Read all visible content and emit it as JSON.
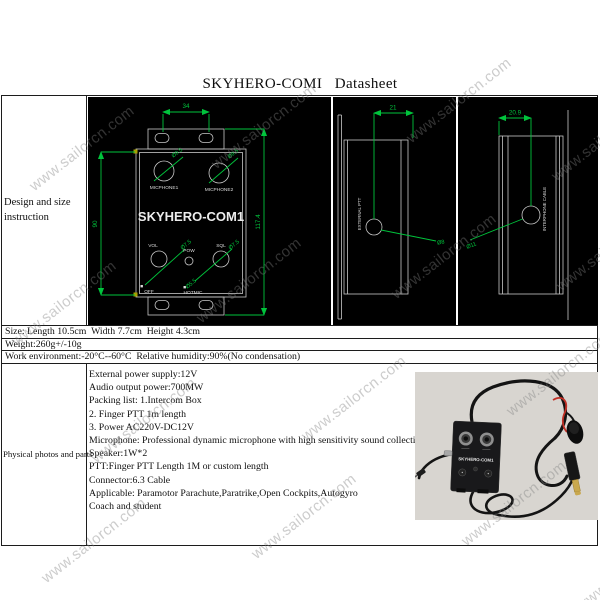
{
  "title": "SKYHERO-COMI   Datasheet",
  "watermark": "www.sailorcn.com",
  "rows": {
    "design_label": "Design and size instruction",
    "size": "Size: Length 10.5cm  Width 7.7cm  Height 4.3cm",
    "weight": "Weight:260g+/-10g",
    "environment": "Work environment:-20°C--60°C  Relative humidity:90%(No condensation)",
    "photos_label": "Physical photos and parts"
  },
  "specs": [
    "External power supply:12V",
    "Audio output power:700MW",
    "Packing list: 1.Intercom Box",
    "2. Finger PTT 1m length",
    "3. Power AC220V-DC12V",
    "Microphone: Professional dynamic microphone with high sensitivity sound collection",
    "Speaker:1W*2",
    "PTT:Finger PTT Length 1M or custom length",
    "Connector:6.3 Cable",
    "Applicable: Paramotor Parachute,Paratrike,Open Cockpits,Autogyro",
    "Coach and student"
  ],
  "drawings": {
    "front": {
      "dim_width_top": "34",
      "dim_height_left": "90",
      "dim_height_right": "117.4",
      "mic1": "MICPHONE1",
      "mic2": "MICPHONE2",
      "name": "SKYHERO-COM1",
      "vol": "VOL",
      "pow": "POW",
      "sql": "SQL",
      "off": "OFF",
      "hotmic": "HOTMIC",
      "mic_hole_dia": "Ø9.5",
      "knob_dia": "Ø7.5",
      "small_hole_dia": "Ø5.5"
    },
    "side_left": {
      "dim_top": "21",
      "label": "EXTERNAL PTT",
      "hole_dia": "Ø8"
    },
    "side_right": {
      "dim_top": "20.9",
      "label": "INTERPHONE CABLE",
      "hole_dia": "Ø11"
    }
  },
  "photo": {
    "device_label": "SKYHERO-COM1"
  },
  "colors": {
    "cad_line": "#00c43c",
    "cad_bg": "#000000",
    "cad_text": "#dcdcdc"
  }
}
